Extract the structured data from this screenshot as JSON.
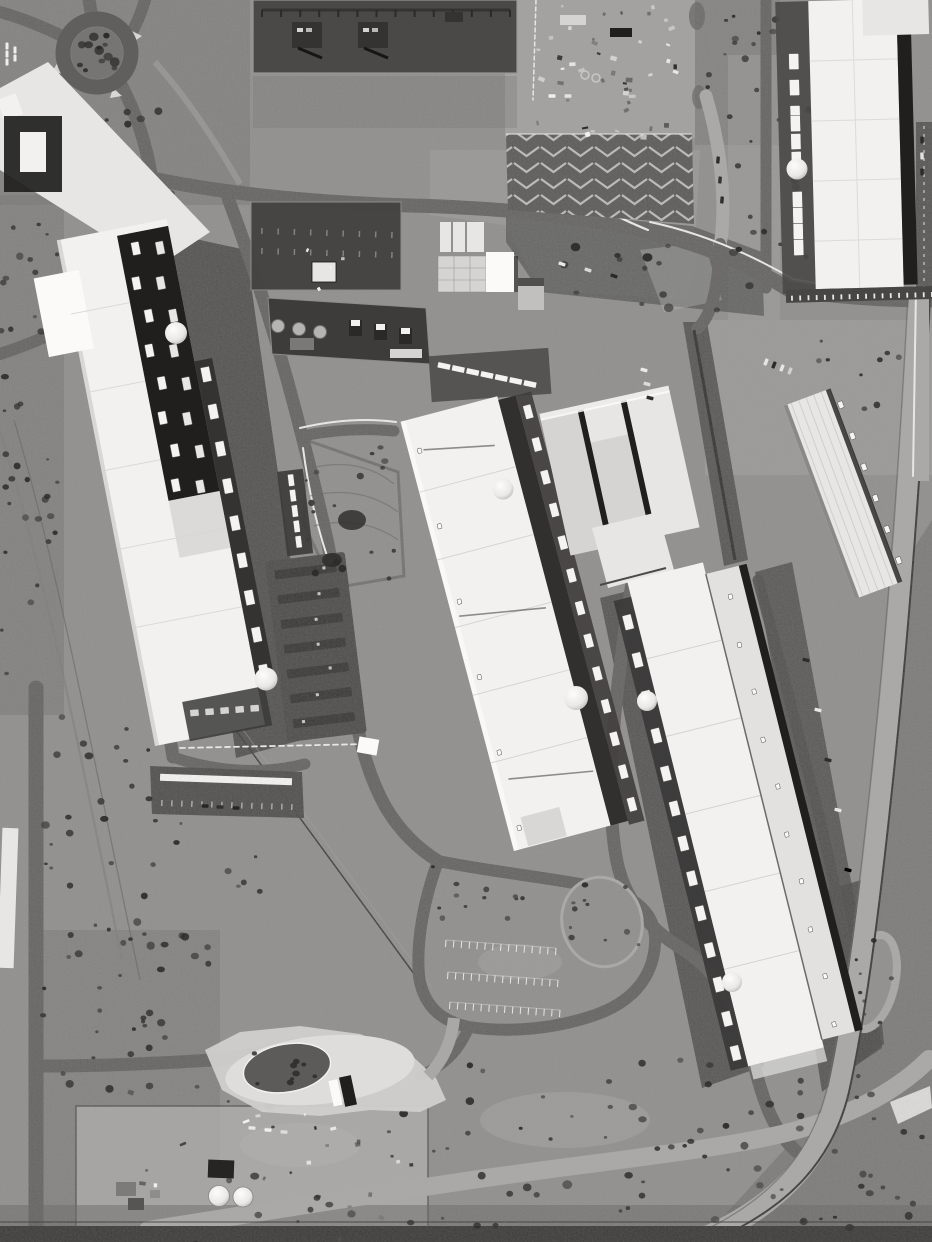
{
  "meta": {
    "type": "aerial-satellite-photograph",
    "subject": "large data center campus with substations, cooling plants, roads and scrubland",
    "color_mode": "grayscale",
    "image_width": 932,
    "image_height": 1242,
    "visible_text": ""
  },
  "palette": {
    "scrub_base": "#8e8d8b",
    "scrub_dark": "#716f6d",
    "scrub_darker": "#62605d",
    "scrub_light": "#a3a2a0",
    "dirt_light": "#b4b3b1",
    "road": "#615f5d",
    "road_dark": "#4d4b49",
    "asphalt": "#484645",
    "gravel": "#a9a8a6",
    "concrete": "#c5c4c2",
    "line_white": "#f2f1ef",
    "paint_white": "#fbfaf8",
    "bldg_white": "#f2f1ef",
    "bldg_white2": "#e7e6e4",
    "bldg_gray": "#d5d4d2",
    "bldg_gray2": "#c1c0be",
    "roof_dark": "#201f1d",
    "shadow": "#171614",
    "sub_yard": "#4b4947",
    "sub_dark": "#353331",
    "bush": "#3b3a37",
    "bush_dark": "#2c2b28",
    "hedge": "#4c4b49",
    "tank": "#f4f3f1"
  },
  "features": [
    {
      "name": "roundabout",
      "description": "traffic circle with tree island, upper left"
    },
    {
      "name": "office-plaza",
      "description": "white plaza and small office building, upper left edge"
    },
    {
      "name": "substation-north",
      "description": "dark fenced electrical yard with busbars and two transformers, top center"
    },
    {
      "name": "substation-mid-upper",
      "description": "dark electrical yard with lattice rows, center"
    },
    {
      "name": "substation-mid-lower",
      "description": "electrical yard with three transformers and round tanks, center"
    },
    {
      "name": "warehouse-block",
      "description": "small white warehouse and gray outbuilding, center"
    },
    {
      "name": "laydown-yard",
      "description": "construction material laydown area, top center-right"
    },
    {
      "name": "chevron-lot",
      "description": "asphalt lot with white chevron hatching, top center-right"
    },
    {
      "name": "datacenter-west",
      "description": "long tilted data hall, white roof with dark rooftop section and cooling units, left"
    },
    {
      "name": "datacenter-center",
      "description": "large white data hall with cooling-unit row and tanks, center"
    },
    {
      "name": "datacenter-center-east",
      "description": "light gray triple-slab building, center right"
    },
    {
      "name": "warehouse-long-east",
      "description": "long narrow white building, right"
    },
    {
      "name": "datacenter-southeast",
      "description": "large white data hall with cooling rows, lower right"
    },
    {
      "name": "datacenter-northeast",
      "description": "white data hall with cooling column, top right"
    },
    {
      "name": "water-tanks",
      "description": "white dome tanks beside each data hall"
    },
    {
      "name": "carport-lots",
      "description": "parking lots with carport rows, center left"
    },
    {
      "name": "visitor-parking-loop",
      "description": "looped parking area with stall rows, bottom center"
    },
    {
      "name": "entrance-gate",
      "description": "white paved security entrance with teardrop island, bottom left"
    },
    {
      "name": "tank-farm",
      "description": "fenced yard with two round tanks and sheds, bottom left"
    },
    {
      "name": "rail-corridor",
      "description": "road and rail corridor curving along the right edge"
    },
    {
      "name": "highway",
      "description": "dark road strip along the bottom edge"
    },
    {
      "name": "scrubland",
      "description": "gray sagebrush scrub surrounding the campus"
    }
  ]
}
